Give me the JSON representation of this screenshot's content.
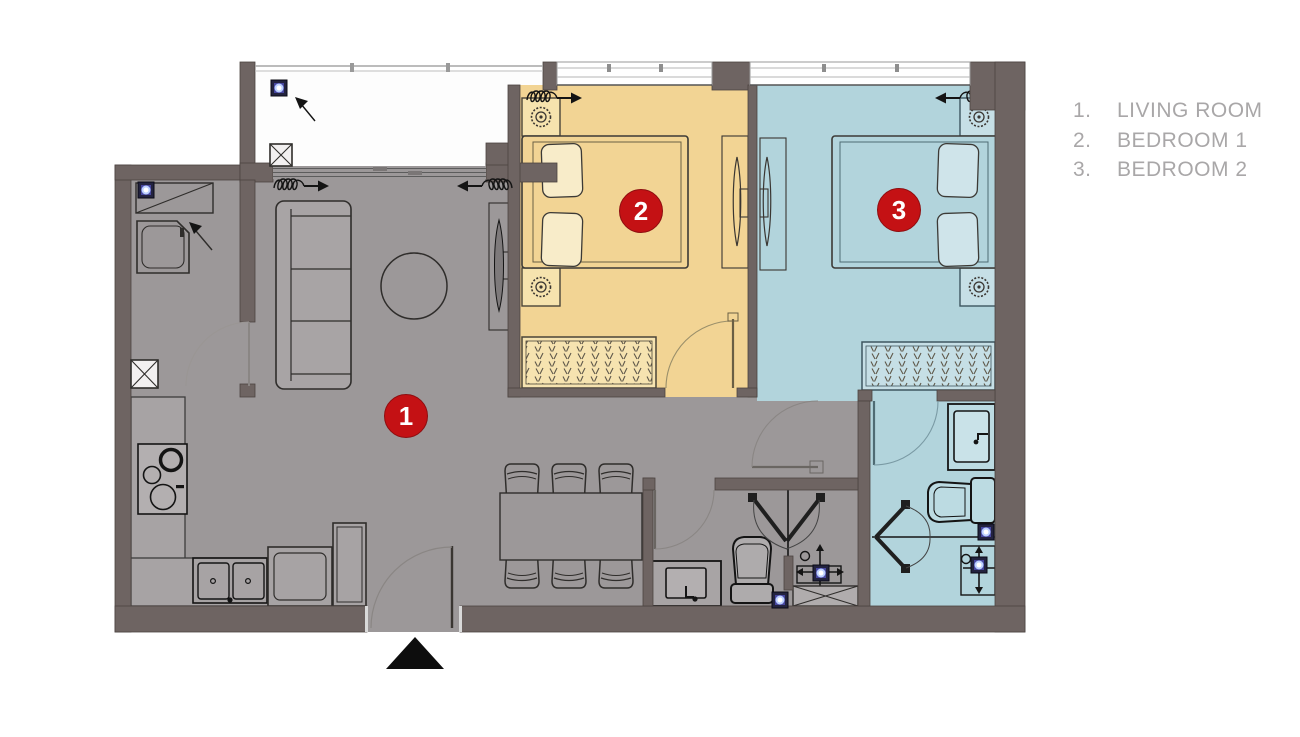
{
  "legend": {
    "items": [
      {
        "num": "1.",
        "label": "LIVING ROOM"
      },
      {
        "num": "2.",
        "label": "BEDROOM 1"
      },
      {
        "num": "3.",
        "label": "BEDROOM 2"
      }
    ]
  },
  "rooms": {
    "living_room": {
      "number": "1"
    },
    "bedroom_1": {
      "number": "2"
    },
    "bedroom_2": {
      "number": "3"
    }
  },
  "colors": {
    "wall": "#6e6462",
    "floor": "#9c9899",
    "bedroom1_floor": "#f2d494",
    "bedroom2_floor": "#b2d4dc",
    "bathroom2_floor": "#b2d4dc",
    "balcony_floor": "#fdfdfd",
    "marker": "#c41114",
    "marker_text": "#ffffff",
    "legend_text": "#a9a7a8"
  }
}
